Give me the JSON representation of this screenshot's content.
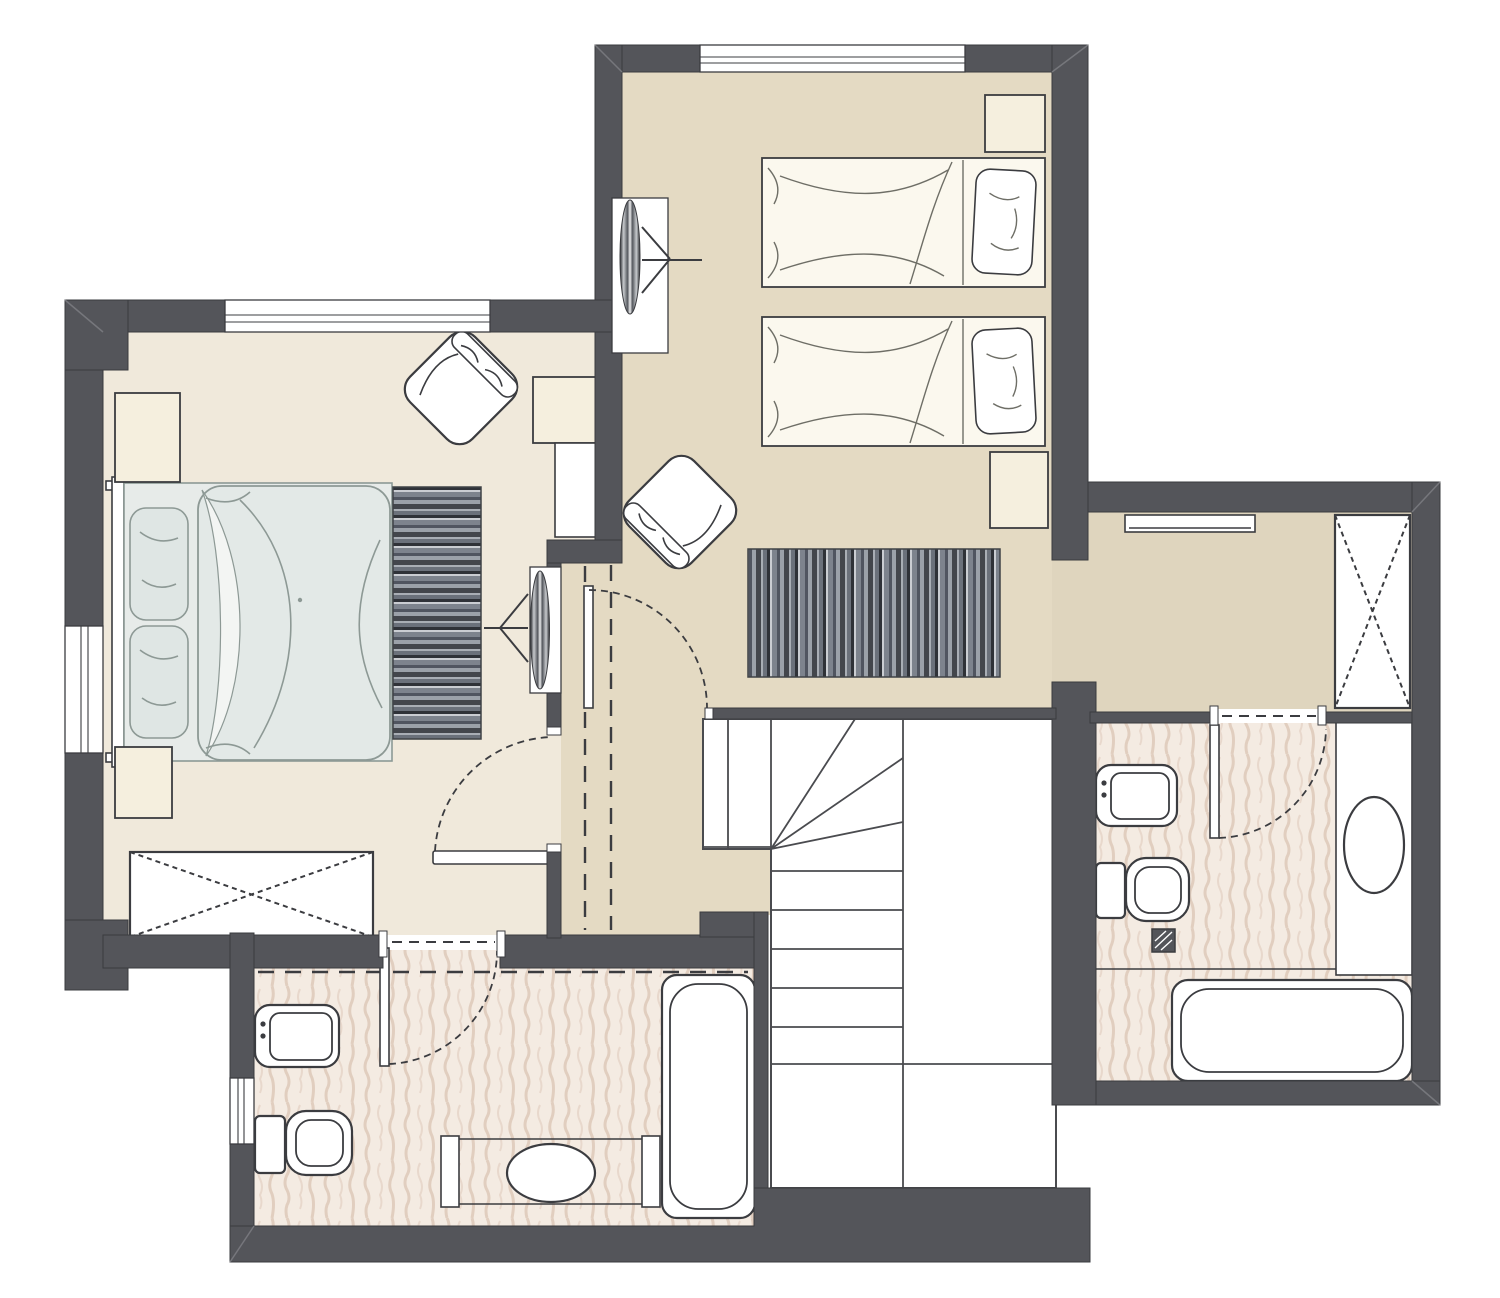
{
  "document": {
    "type": "architectural-floor-plan",
    "floor": "upper-floor",
    "visible_text": []
  },
  "colors": {
    "wall": "#54555A",
    "wall_edge": "#3A3B3F",
    "line": "#3B3C40",
    "stair_line": "#4A4B4F",
    "miter": "#76777C",
    "paper": "#FFFFFF",
    "floor_master": "#F0E9DB",
    "floor_hall": "#E4DAC3",
    "floor_corridor": "#DFD5BE",
    "tile_base": "#F4EBE2",
    "tile_streak": "#D9C2B1",
    "furniture_cream": "#F5EFDE",
    "bed_base": "#E7EBE9",
    "duvet_fill": "#E3E9E7",
    "duvet_line": "#8D9995",
    "pillow": "#DFE6E4",
    "sheet": "#F3F5F3",
    "twin_fill": "#FBF8EE",
    "twin_line": "#6E6E66",
    "bench_edge": "#3F4246",
    "bench_stripe_1": "#43464C",
    "bench_stripe_2": "#A9AEB5",
    "bench_stripe_3": "#6B717B",
    "bench_stripe_4": "#2F3238",
    "bench_stripe_5": "#CACDD2",
    "bench_stripe_6": "#7D838D",
    "bench_stripe_7": "#505560",
    "bench_stripe_8": "#9BA1A9",
    "lens_dark": "#2B2C30",
    "lens_silver": "#C7CACD",
    "lens_mid": "#55585E",
    "lens_light": "#EFF0F1"
  },
  "rooms": [
    {
      "id": "master-bedroom",
      "floor": "floor_master",
      "furniture": [
        "double-bed",
        "headboard",
        "pillow",
        "pillow",
        "nightstand",
        "nightstand",
        "wardrobe-x",
        "foot-bench",
        "armchair",
        "side-table",
        "dresser",
        "wall-tv"
      ]
    },
    {
      "id": "twin-bedroom",
      "floor": "floor_hall",
      "furniture": [
        "single-bed",
        "single-bed",
        "nightstand",
        "nightstand",
        "wall-tv"
      ]
    },
    {
      "id": "hallway",
      "floor": "floor_hall",
      "furniture": [
        "bench",
        "armchair",
        "stair-door"
      ]
    },
    {
      "id": "corridor",
      "floor": "floor_corridor",
      "furniture": [
        "wall-shelf",
        "closet-x"
      ]
    },
    {
      "id": "staircase",
      "floor": "paper",
      "furniture": [
        "winder-steps",
        "straight-steps",
        "railing"
      ]
    },
    {
      "id": "bathroom-left",
      "floor": "tile_base",
      "furniture": [
        "washbasin",
        "toilet",
        "vanity-counter",
        "oval-basin",
        "bathtub",
        "door"
      ]
    },
    {
      "id": "bathroom-right",
      "floor": "tile_base",
      "furniture": [
        "washbasin",
        "toilet",
        "floor-drain",
        "vanity-counter",
        "oval-basin",
        "bathtub",
        "door"
      ]
    }
  ],
  "symbols": [
    "window",
    "door-swing-arc",
    "roof-slope-dashed-line",
    "wardrobe-cross",
    "tv-direction-arrow"
  ]
}
